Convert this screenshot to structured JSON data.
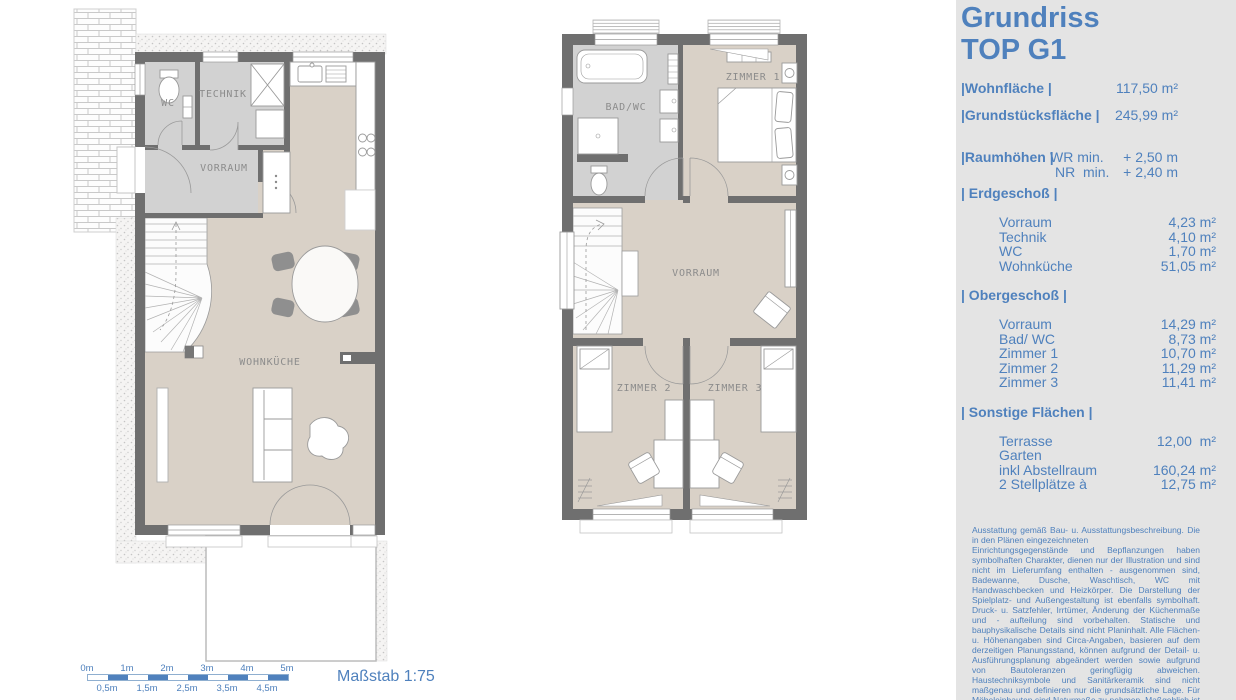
{
  "panel": {
    "title": [
      "Grundriss",
      "TOP G1"
    ],
    "summary": [
      {
        "label": "|Wohnfläche |",
        "value": "117,50 m²"
      },
      {
        "label": "|Grundstücksfläche |",
        "value": "245,99 m²"
      }
    ],
    "raumhoehen": {
      "label": "|Raumhöhen |",
      "rows": [
        {
          "key": "WR min.",
          "value": "+ 2,50 m"
        },
        {
          "key": "NR  min.",
          "value": "+ 2,40 m"
        }
      ]
    },
    "erdgeschoss": {
      "header": "| Erdgeschoß |",
      "rows": [
        {
          "label": "Vorraum",
          "value": "4,23 m²"
        },
        {
          "label": "Technik",
          "value": "4,10 m²"
        },
        {
          "label": "WC",
          "value": "1,70 m²"
        },
        {
          "label": "Wohnküche",
          "value": "51,05 m²"
        }
      ]
    },
    "obergeschoss": {
      "header": "| Obergeschoß |",
      "rows": [
        {
          "label": "Vorraum",
          "value": "14,29 m²"
        },
        {
          "label": "Bad/ WC",
          "value": "8,73 m²"
        },
        {
          "label": "Zimmer 1",
          "value": "10,70 m²"
        },
        {
          "label": "Zimmer 2",
          "value": "11,29 m²"
        },
        {
          "label": "Zimmer 3",
          "value": "11,41 m²"
        }
      ]
    },
    "sonstige": {
      "header": "| Sonstige Flächen |",
      "rows": [
        {
          "label": "Terrasse",
          "value": "12,00  m²"
        },
        {
          "label": "Garten",
          "value": ""
        },
        {
          "label": "inkl Abstellraum",
          "value": "160,24 m²"
        },
        {
          "label": "2 Stellplätze à",
          "value": "12,75 m²"
        }
      ]
    },
    "disclaimer": "Ausstattung gemäß Bau- u. Ausstattungsbeschreibung. Die in den Plänen eingezeichneten\nEinrichtungsgegenstände und Bepflanzungen haben symbolhaften Charakter, dienen nur der Illustration und sind nicht im Lieferumfang enthalten - ausgenommen sind, Badewanne, Dusche, Waschtisch, WC mit Handwaschbecken und Heizkörper. Die Darstellung der Spielplatz- und Außengestaltung ist ebenfalls symbolhaft. Druck- u. Satzfehler, Irrtümer, Änderung der Küchenmaße und - aufteilung sind vorbehalten. Statische und bauphysikalische Details sind nicht Planinhalt. Alle Flächen- u. Höhenangaben sind Circa-Angaben, basieren auf dem derzeitigen Planungsstand, können aufgrund der Detail- u. Ausführungsplanung abgeändert werden sowie aufgrund von Bautoleranzen geringfügig abweichen. Haustechniksymbole und Sanitärkeramik sind nicht maßgenau und definieren nur die grundsätzliche Lage. Für Möbeleinbauten sind Naturmaße zu nehmen. Maßgeblich ist in jedem Fall der Kaufvertrag."
  },
  "plans": {
    "ground": {
      "wc": "WC",
      "technik": "TECHNIK",
      "vorraum": "VORRAUM",
      "wohnkueche": "WOHNKÜCHE"
    },
    "upper": {
      "bad": "BAD/WC",
      "zimmer1": "ZIMMER 1",
      "vorraum": "VORRAUM",
      "zimmer2": "ZIMMER 2",
      "zimmer3": "ZIMMER 3"
    }
  },
  "scalebar": {
    "top": [
      "0m",
      "1m",
      "2m",
      "3m",
      "4m",
      "5m"
    ],
    "bottom": [
      "0,5m",
      "1,5m",
      "2,5m",
      "3,5m",
      "4,5m"
    ],
    "caption": "Maßstab 1:75"
  },
  "colors": {
    "accent": "#4f81bd",
    "wall": "#6f6f6f",
    "floor_beige": "#d9d1c7",
    "floor_gray": "#d2d2d2",
    "panel_bg": "#e4e4e4"
  }
}
